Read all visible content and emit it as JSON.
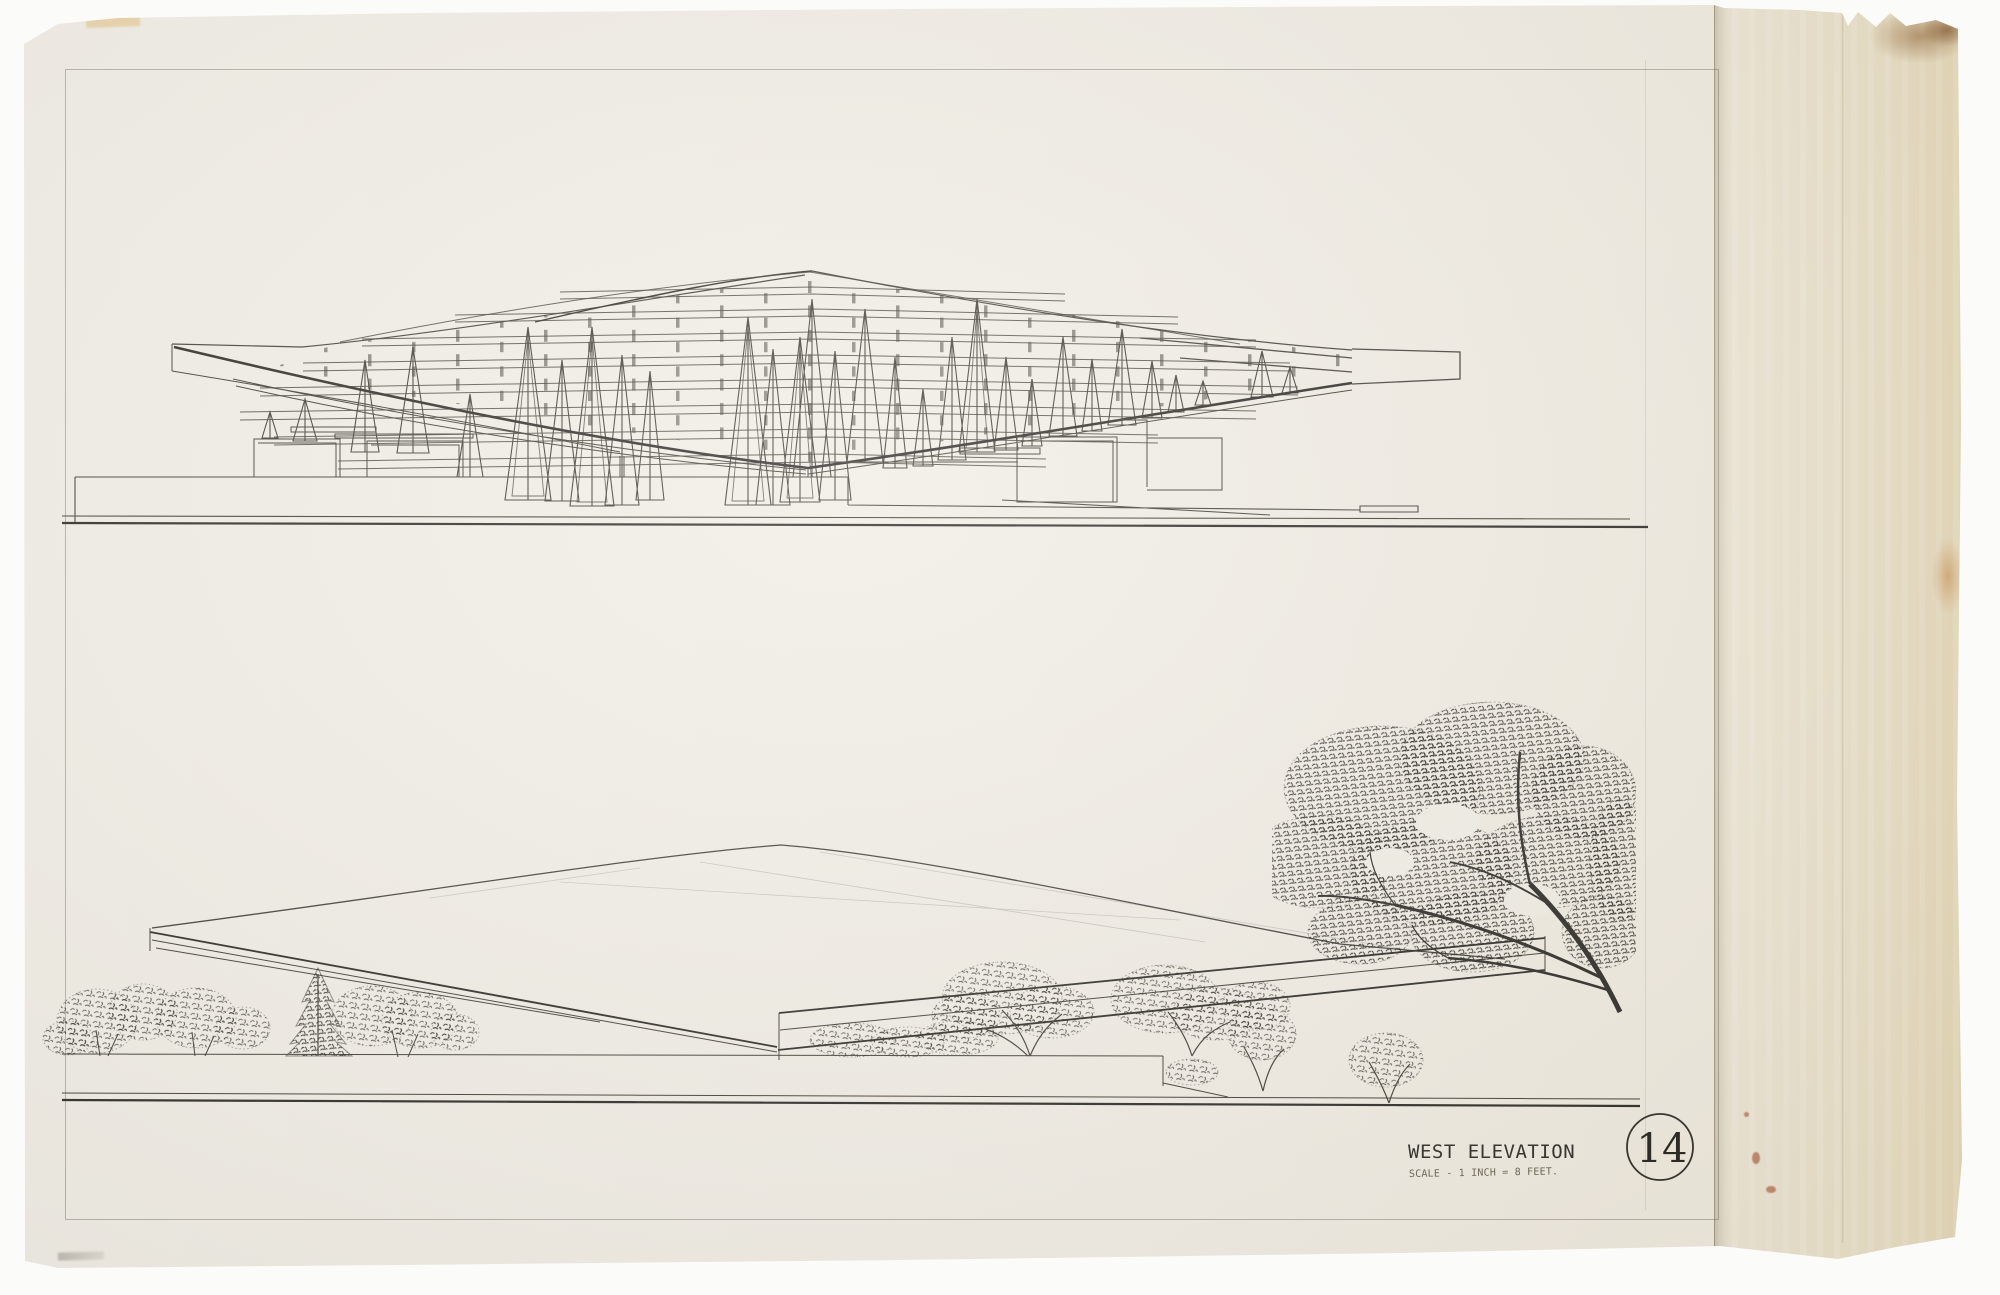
{
  "title_block": {
    "title": "WEST ELEVATION",
    "scale_note": "SCALE - 1 INCH = 8 FEET.",
    "sheet_number": "14"
  },
  "colors": {
    "backdrop": "#fbfbf9",
    "paper": "#f0ede5",
    "aged_strip": "#e9e0ca",
    "aged_strip_deep": "#e4d7b6",
    "pencil_line": "#403d36",
    "pencil_dark": "#2b2924",
    "stain_brown": "#8a5826",
    "stain_orange": "#c07f3a",
    "stain_red": "#a34a28",
    "tape_yellow": "#ddaf56"
  }
}
